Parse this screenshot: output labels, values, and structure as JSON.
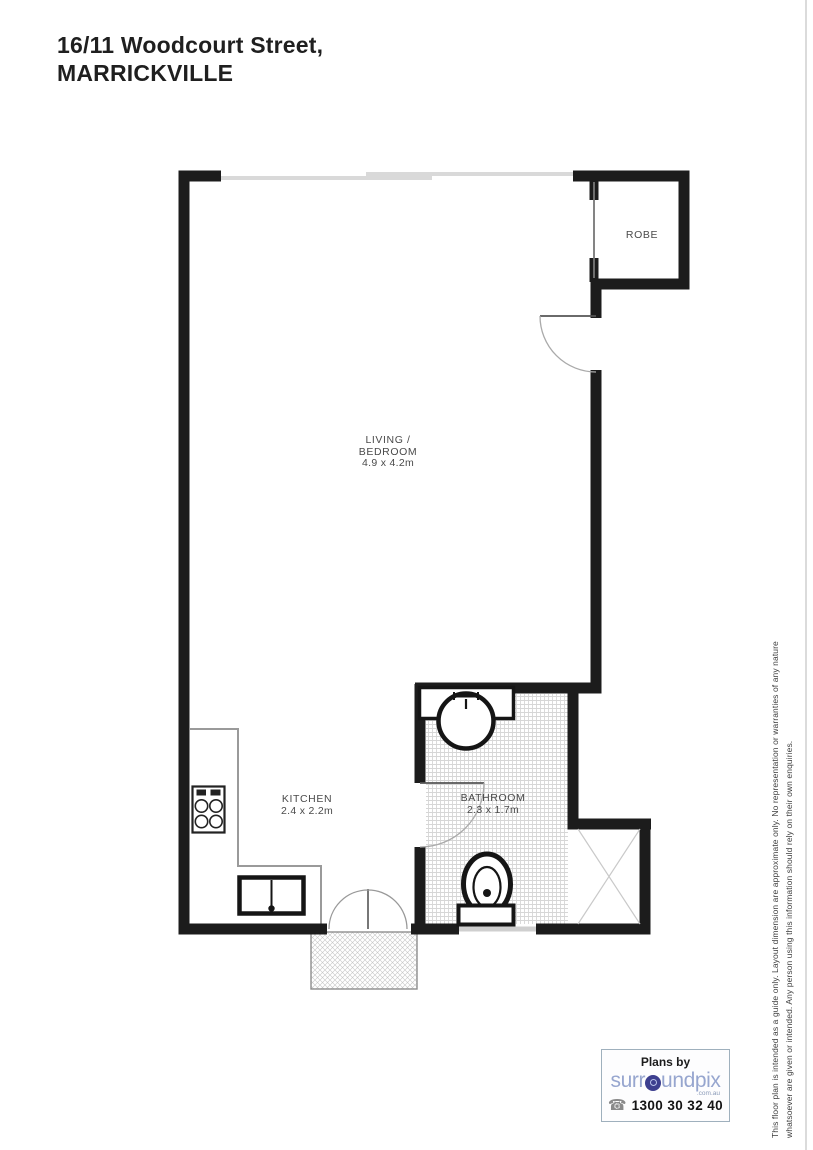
{
  "header": {
    "address_line1": "16/11 Woodcourt Street,",
    "address_line2": "MARRICKVILLE"
  },
  "rooms": {
    "living": {
      "label_line1": "LIVING /",
      "label_line2": "BEDROOM",
      "dimensions": "4.9 x 4.2m"
    },
    "kitchen": {
      "label": "KITCHEN",
      "dimensions": "2.4 x 2.2m"
    },
    "bathroom": {
      "label": "BATHROOM",
      "dimensions": "2.3 x 1.7m"
    },
    "robe": {
      "label": "ROBE"
    }
  },
  "fixtures": [
    "stove-icon",
    "kitchen-sink-icon",
    "basin-icon",
    "toilet-icon",
    "shower-icon",
    "entry-door",
    "bathroom-door",
    "french-doors",
    "balcony",
    "windows"
  ],
  "disclaimer": {
    "line1": "This floor plan is intended as a guide only. Layout dimension are approximate only. No representation or warranties of any nature",
    "line2": "whatsoever are given or intended. Any person using this information should rely on their own enquiries."
  },
  "branding": {
    "plans_by": "Plans by",
    "brand_name": "surroundpix",
    "brand_prefix": "surr",
    "brand_suffix": "undpix",
    "domain": ".com.au",
    "phone": "1300 30 32 40",
    "phone_icon": "☎"
  },
  "colors": {
    "wall": "#1c1c1c",
    "window": "#d9d9d9",
    "counter_line": "#9a9a9a",
    "hatch": "#d6d6d6",
    "brand_text": "#97a6cf",
    "brand_globe": "#3d3f8f",
    "label_text": "#4a4a4a"
  }
}
